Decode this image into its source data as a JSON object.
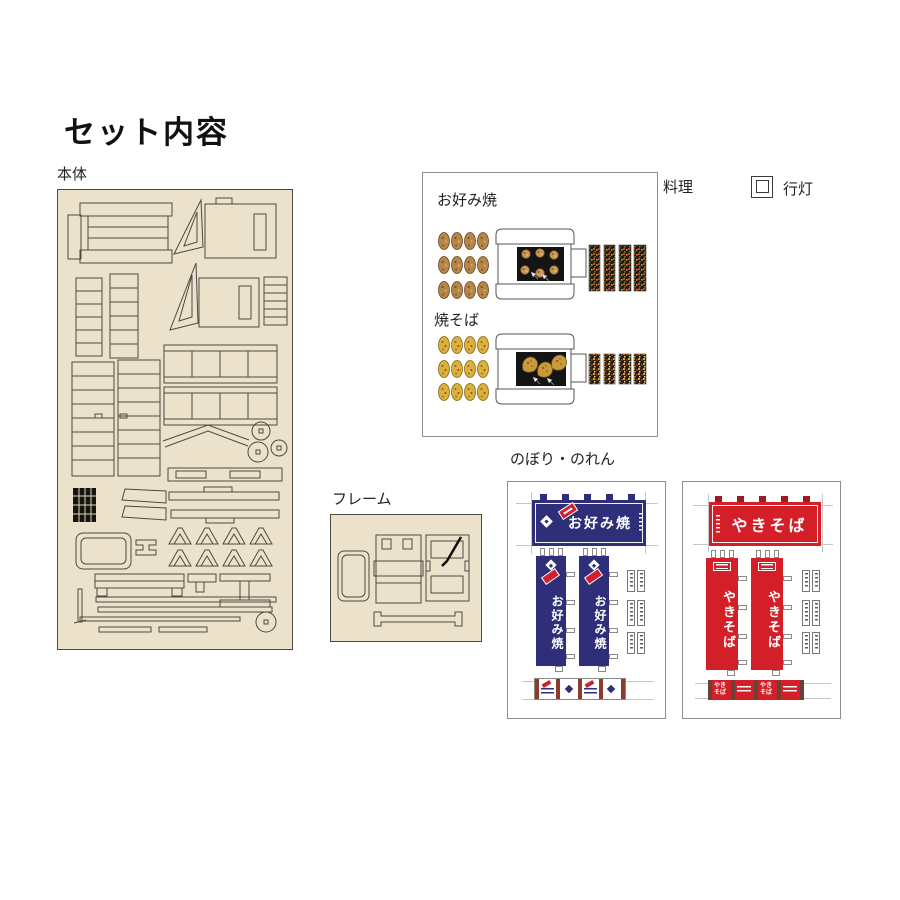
{
  "title": "セット内容",
  "colors": {
    "sheet_beige": "#ece2cb",
    "navy_banner": "#2e2f78",
    "red_banner": "#d41f28",
    "outline": "#4a4a42"
  },
  "sections": {
    "hontai": {
      "label": "本体"
    },
    "ryori": {
      "label": "料理",
      "okonomiyaki_label": "お好み焼",
      "yakisoba_label": "焼そば"
    },
    "andon": {
      "label": "行灯"
    },
    "frame": {
      "label": "フレーム"
    },
    "nobori": {
      "label": "のぼり・のれん",
      "okonomiyaki": {
        "text": "お好み焼"
      },
      "yakisoba": {
        "text": "やきそば"
      }
    }
  }
}
